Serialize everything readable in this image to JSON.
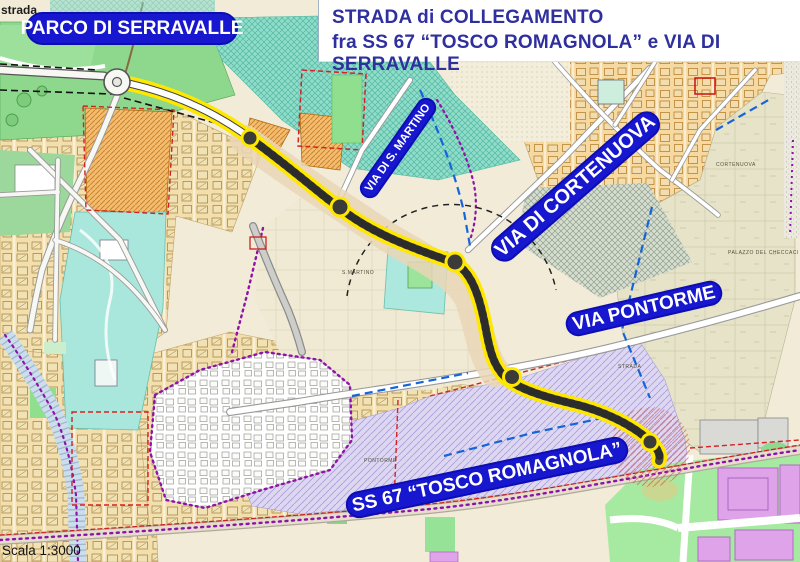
{
  "title": {
    "line1": "STRADA di COLLEGAMENTO",
    "line2": "fra SS 67 “TOSCO ROMAGNOLA” e VIA DI SERRAVALLE"
  },
  "corner_label": "strada",
  "scale_label": "Scala 1:3000",
  "road_labels": [
    {
      "id": "parco-di-serravalle",
      "text": "PARCO DI SERRAVALLE"
    },
    {
      "id": "via-di-s-martino",
      "text": "VIA DI S. MARTINO"
    },
    {
      "id": "via-di-cortenuova",
      "text": "VIA DI CORTENUOVA"
    },
    {
      "id": "via-pontorme",
      "text": "VIA PONTORME"
    },
    {
      "id": "ss67-tosco-romagnola",
      "text": "SS 67 “TOSCO ROMAGNOLA”"
    }
  ],
  "micro_labels": [
    {
      "text": "CORTENUOVA"
    },
    {
      "text": "PALAZZO DEL CHECCACI"
    },
    {
      "text": "PONTORME"
    },
    {
      "text": "STRADA"
    },
    {
      "text": "S.MARTINO"
    }
  ],
  "colors": {
    "label_pill_blue": "#1717cf",
    "title_navy": "#2f2f9e",
    "route_highlight_yellow": "#ffe800",
    "route_asphalt_gray": "#474645",
    "map_paper_cream": "#f1ebd8",
    "boundary_purple": "#8b14a8",
    "park_green": "#8ed88e",
    "zone_teal": "#8edcc9",
    "zone_orange": "#f2bd72",
    "zone_lavender": "#ddd7f1"
  }
}
